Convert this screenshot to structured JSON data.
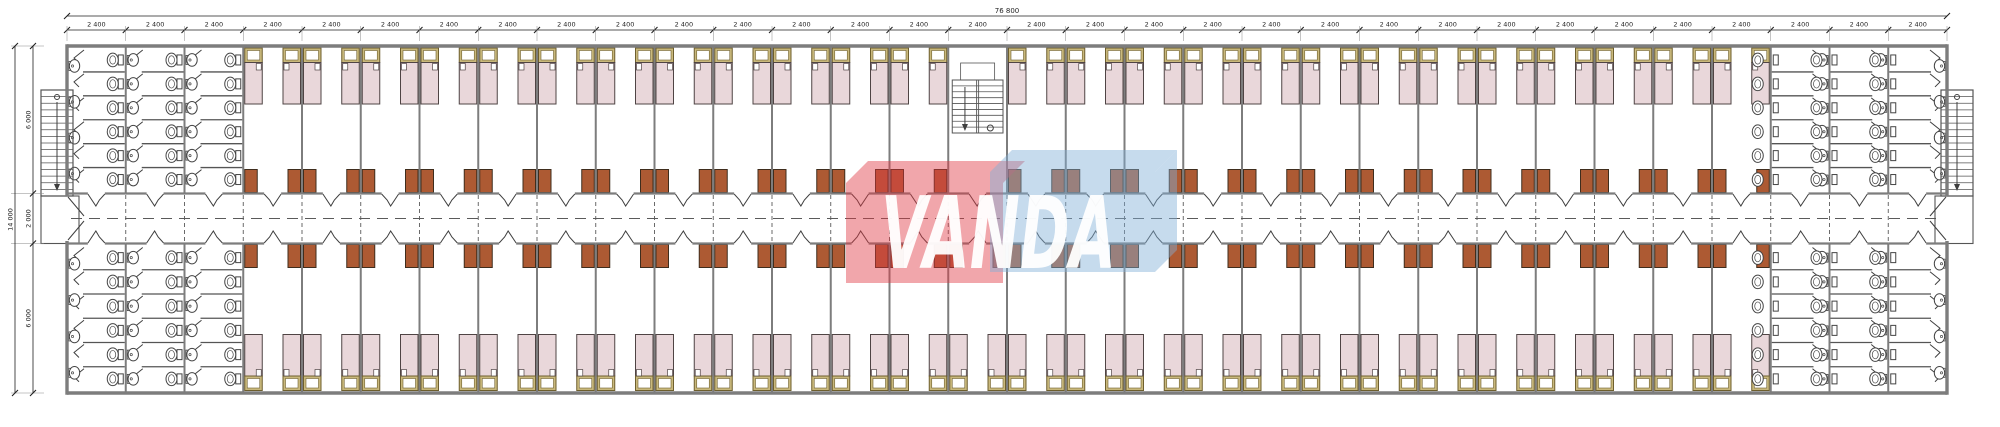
{
  "watermark": {
    "text": "VANDA",
    "red_box_color": "rgba(224,58,68,0.45)",
    "blue_box_color": "rgba(128,175,216,0.45)",
    "text_color": "rgba(255,255,255,0.95)"
  },
  "dimensions": {
    "total_width_label": "76 800",
    "module_label": "2 400",
    "module_count": 32,
    "total_height_label": "14 000",
    "height_segments": [
      "6 000",
      "2 000",
      "6 000"
    ]
  },
  "plan": {
    "colors": {
      "wall": "#7d7d7d",
      "line": "#3f3f3f",
      "thin": "#555555",
      "dim": "#1f1f1f",
      "ext": "#8a8a8a",
      "bed_fill": "#e9d7da",
      "bed_stroke": "#4f4444",
      "headboard_fill": "#c9b87c",
      "headboard_stroke": "#6e5f2e",
      "locker_fill": "#ad5a33",
      "locker_stroke": "#3f2d1d",
      "fixture": "#444444",
      "dash": "#5a5a5a"
    },
    "bedroom_zone": {
      "start_module": 4,
      "end_module": 29
    },
    "central_stair_module_top_row": 16,
    "sanitary": {
      "blocks": 2,
      "modules_per_block": 3,
      "stall_rows": 6,
      "entry_sinks": 4,
      "wall_sinks": 6
    },
    "stairs": {
      "external": 2,
      "treads": 16
    }
  }
}
